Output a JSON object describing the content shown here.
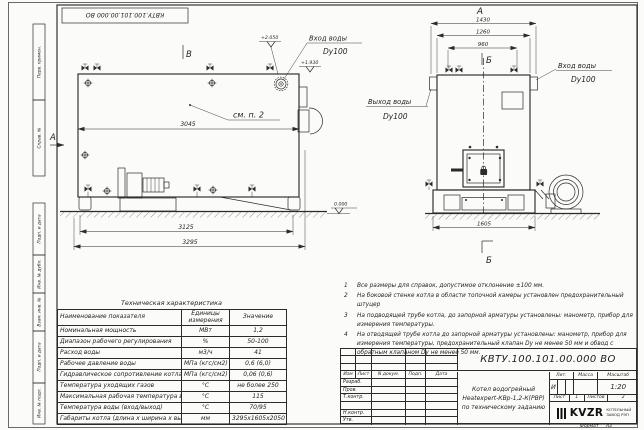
{
  "frame": {
    "stamp_top": "КВТУ.100.101.00.000  ВО",
    "sidebar_top": [
      "Перв. примен.",
      "Справ. №"
    ],
    "sidebar_bottom": [
      "Подп. и дата",
      "Инв. № дубл.",
      "Взам. инв. №",
      "Подп. и дата",
      "Инв. № подл."
    ],
    "format_label": "Формат",
    "format_value": "А3"
  },
  "side_view": {
    "view_label": "В",
    "arrow_label": "А",
    "callout": "см. п. 2",
    "dim_width": "3045",
    "dim_base": "3125",
    "dim_overall": "3295",
    "elev_top": "+2.050",
    "elev_inlet": "+1.930",
    "elev_zero": "0.000",
    "inlet_title": "Вход воды",
    "inlet_dn": "Dy100"
  },
  "front_view": {
    "view_label": "А",
    "section_label_top": "Б",
    "section_label_bottom": "Б",
    "dim_overall": "1430",
    "dim_body": "1260",
    "dim_valves": "960",
    "dim_base": "1605",
    "inlet_title": "Вход воды",
    "inlet_dn": "Dy100",
    "outlet_title": "Выход воды",
    "outlet_dn": "Dy100"
  },
  "notes": {
    "items": [
      {
        "num": "1",
        "text": "Все размеры для справок, допустимое отклонение ±100 мм."
      },
      {
        "num": "2",
        "text": "На боковой стенке котла в области топочной камеры установлен предохранительный штуцер"
      },
      {
        "num": "3",
        "text": "На подводящей трубе котла, до запорной арматуры установлены: манометр, прибор для измерения температуры."
      },
      {
        "num": "4",
        "text": "На отводящей трубе котла до запорной арматуры установлены: манометр, прибор для измерения температуры, предохранительный клапан Dу не менее 50 мм и обвод с обратным клапаном Dу не менее 50 мм."
      }
    ]
  },
  "spec_table": {
    "title": "Техническая характеристика",
    "col_name": "Наименование показателя",
    "col_units": "Единицы измерения",
    "col_value": "Значение",
    "rows": [
      {
        "name": "Номинальная мощность",
        "units": "МВт",
        "value": "1,2"
      },
      {
        "name": "Диапазон рабочего регулирования",
        "units": "%",
        "value": "50-100"
      },
      {
        "name": "Расход воды",
        "units": "м3/ч",
        "value": "41"
      },
      {
        "name": "Рабочее давление воды",
        "units": "МПа (кгс/см2)",
        "value": "0,6 (6,0)"
      },
      {
        "name": "Гидравлическое сопротивление котла",
        "units": "МПа (кгс/см2)",
        "value": "0,06 (0,6)"
      },
      {
        "name": "Температура уходящих газов",
        "units": "°С",
        "value": "не более 250"
      },
      {
        "name": "Максимальная рабочая температура воды",
        "units": "°С",
        "value": "115"
      },
      {
        "name": "Температура воды (вход/выход)",
        "units": "°С",
        "value": "70/95"
      },
      {
        "name": "Габариты котла (длина х ширина х высота)",
        "units": "мм",
        "value": "3295х1605х2050"
      }
    ]
  },
  "title_block": {
    "doc_number": "КВТУ.100.101.00.000  ВО",
    "col_izm": "Изм",
    "col_list": "Лист",
    "col_ndoc": "N докум.",
    "col_podp": "Подп.",
    "col_data": "Дата",
    "roles": [
      "Разраб.",
      "Пров.",
      "Т.контр.",
      "Н.контр.",
      "Утв."
    ],
    "desc_line1": "Котел водогрейный",
    "desc_line2": "Heatexpert-КВр-1,2-К(РВР)",
    "desc_line3": "по техническому заданию",
    "lit_label": "Лит.",
    "mass_label": "Масса",
    "scale_label": "Масштаб",
    "lit_value": "И",
    "scale_value": "1:20",
    "sheet_label": "Лист",
    "sheet_value": "1",
    "sheets_label": "Листов",
    "sheets_value": "2",
    "logo_text": "KVZR",
    "company_line1": "КОТЕЛЬНЫЙ",
    "company_line2": "ЗАВОД РЭП"
  }
}
